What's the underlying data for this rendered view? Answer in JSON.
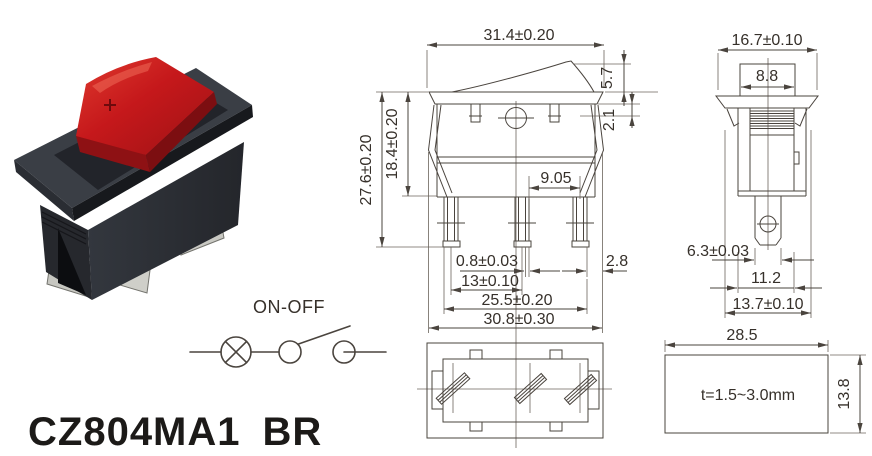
{
  "title": {
    "model": "CZ804MA1",
    "variant": "BR"
  },
  "schematic": {
    "label": "ON-OFF"
  },
  "front_view": {
    "dims": {
      "overall_width": "31.4±0.20",
      "rocker_height": "5.7",
      "flange_step": "2.1",
      "overall_height": "27.6±0.20",
      "upper_body_height": "18.4±0.20",
      "terminal_gap": "9.05",
      "terminal_thickness": "0.8±0.03",
      "terminal_pitch": "13±0.10",
      "terminal_span": "25.5±0.20",
      "body_width": "30.8±0.30",
      "edge_offset": "2.8"
    }
  },
  "side_view": {
    "dims": {
      "flange_depth": "16.7±0.10",
      "rocker_depth": "8.8",
      "terminal_width": "6.3±0.03",
      "body_depth": "11.2",
      "housing_depth": "13.7±0.10"
    }
  },
  "panel_cutout": {
    "dims": {
      "width": "28.5",
      "height": "13.8"
    },
    "note": "t=1.5~3.0mm"
  },
  "colors": {
    "line": "#4a443e",
    "text": "#36302a",
    "rocker_red": "#c5181b",
    "housing_dark": "#2a2d33",
    "terminal_silver": "#c7c7c1"
  }
}
